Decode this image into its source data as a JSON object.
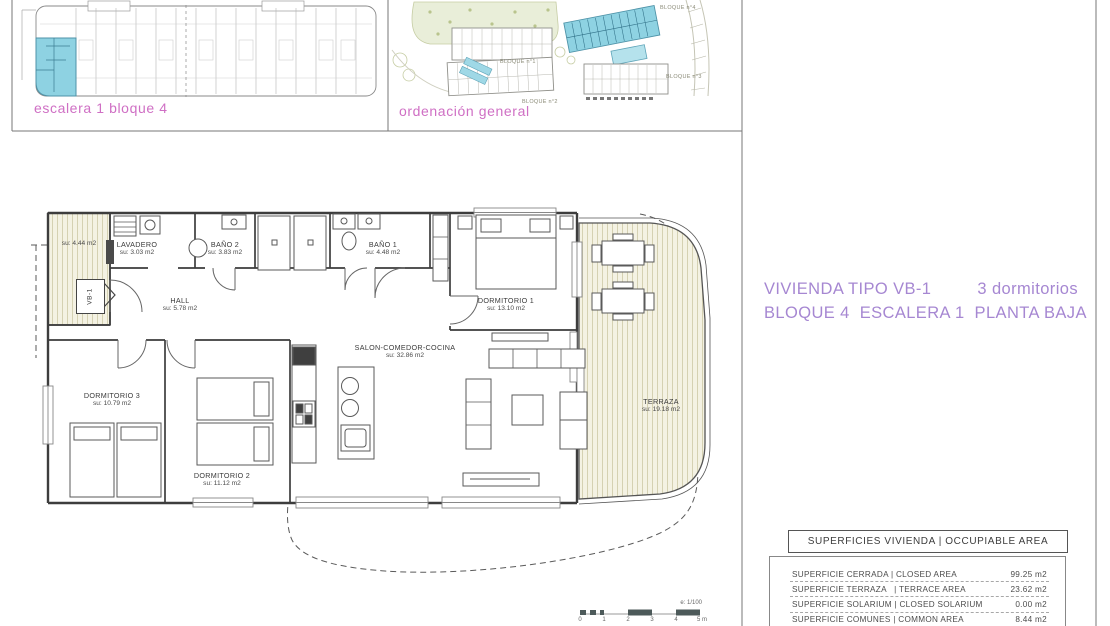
{
  "colors": {
    "accent_pink": "#cf6fc4",
    "accent_purple": "#a687d2",
    "highlight_cyan": "#8ed2e2",
    "hatch_beige": "#f4f2e3"
  },
  "thumbnails": {
    "left_caption": "escalera 1 bloque 4",
    "right_caption": "ordenación general",
    "site_labels": [
      {
        "text": "BLOQUE n°4"
      },
      {
        "text": "BLOQUE n°1"
      },
      {
        "text": "BLOQUE n°2"
      },
      {
        "text": "BLOQUE n°3"
      }
    ]
  },
  "title": {
    "line1_left": "VIVIENDA TIPO VB-1",
    "line1_right": "3 dormitorios",
    "line2": "BLOQUE 4  ESCALERA 1  PLANTA BAJA"
  },
  "floorplan": {
    "unit_tag": "VB-1",
    "rooms": [
      {
        "name": "",
        "area": "su: 4.44 m2"
      },
      {
        "name": "LAVADERO",
        "area": "su: 3.03 m2"
      },
      {
        "name": "BAÑO 2",
        "area": "su: 3.83 m2"
      },
      {
        "name": "BAÑO 1",
        "area": "su: 4.48 m2"
      },
      {
        "name": "DORMITORIO 1",
        "area": "su: 13.10 m2"
      },
      {
        "name": "HALL",
        "area": "su: 5.78 m2"
      },
      {
        "name": "SALON-COMEDOR-COCINA",
        "area": "su: 32.86 m2"
      },
      {
        "name": "DORMITORIO 3",
        "area": "su: 10.79 m2"
      },
      {
        "name": "DORMITORIO 2",
        "area": "su: 11.12 m2"
      },
      {
        "name": "TERRAZA",
        "area": "su: 19.18 m2"
      }
    ],
    "scale": {
      "label": "e: 1/100",
      "ticks": [
        "0",
        "1",
        "2",
        "3",
        "4",
        "5 m"
      ]
    }
  },
  "areas_table": {
    "header": "SUPERFICIES VIVIENDA | OCCUPIABLE AREA",
    "rows": [
      {
        "label": "SUPERFICIE CERRADA | CLOSED AREA",
        "value": "99.25 m2"
      },
      {
        "label": "SUPERFICIE TERRAZA   | TERRACE AREA",
        "value": "23.62 m2"
      },
      {
        "label": "SUPERFICIE SOLARIUM | CLOSED SOLARIUM",
        "value": "0.00 m2"
      },
      {
        "label": "SUPERFICIE COMUNES | COMMON AREA",
        "value": "8.44 m2"
      }
    ]
  }
}
